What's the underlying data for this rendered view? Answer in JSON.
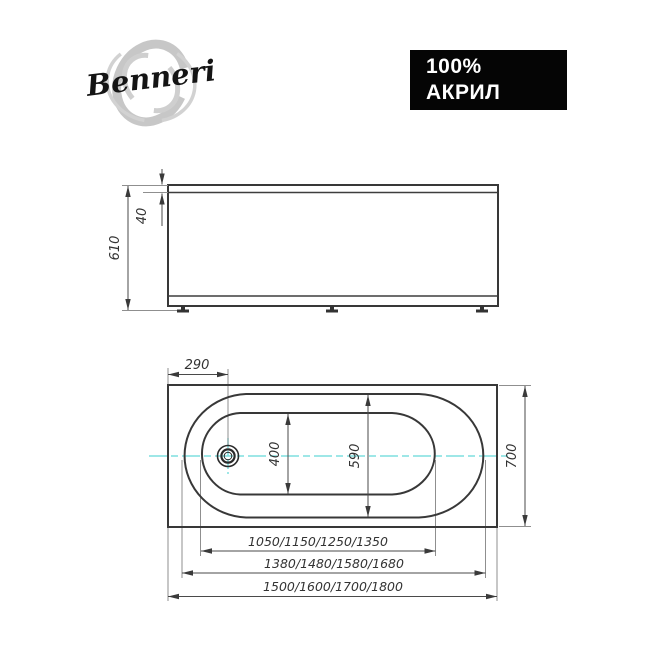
{
  "brand": {
    "name": "Benneri"
  },
  "badge": {
    "line1": "100%",
    "line2": "АКРИЛ",
    "background": "#050505",
    "text_color": "#ffffff"
  },
  "colors": {
    "object_line": "#383838",
    "dimension_line": "#4a4a4a",
    "extension_line": "#8f8f8f",
    "centerline": "#7fdfdf",
    "logo_brush": "#c7c7c7"
  },
  "side_view": {
    "overall_height_mm": "610",
    "rim_height_mm": "40"
  },
  "top_view": {
    "drain_offset_mm": "290",
    "bottom_width_mm": "400",
    "rim_inner_width_mm": "590",
    "overall_width_mm": "700",
    "bottom_length_options_mm": "1050/1150/1250/1350",
    "rim_inner_length_options_mm": "1380/1480/1580/1680",
    "overall_length_options_mm": "1500/1600/1700/1800"
  }
}
